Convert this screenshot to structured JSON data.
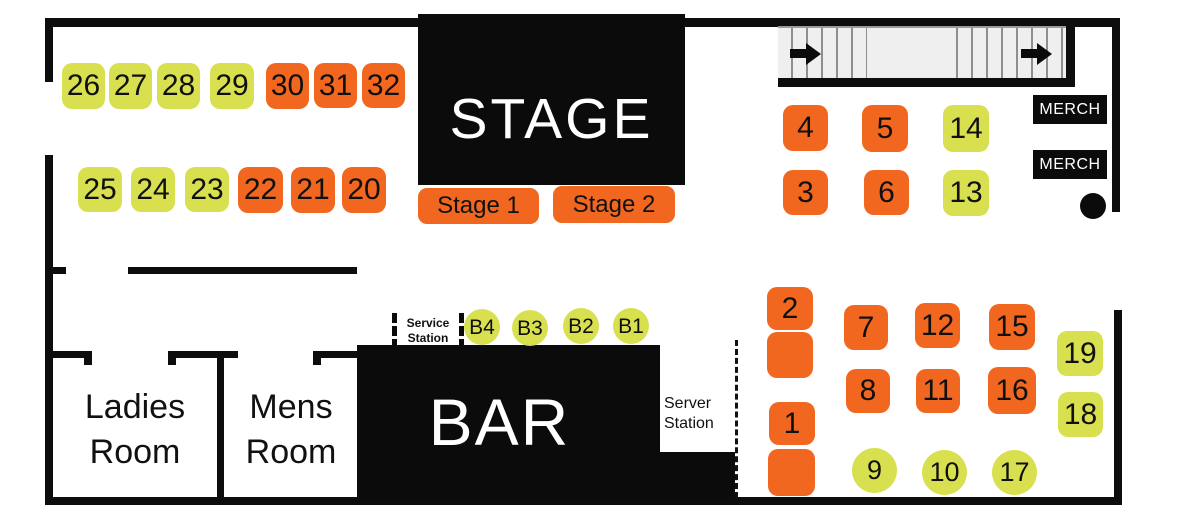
{
  "title": "Venue floor plan seating map",
  "colors": {
    "orange": "#f2671f",
    "yellow": "#d9e04f",
    "wall": "#0d0d0d"
  },
  "stage": {
    "title": "STAGE",
    "stage1_label": "Stage 1",
    "stage2_label": "Stage 2"
  },
  "bar": {
    "title": "BAR"
  },
  "merch": {
    "top_label": "MERCH",
    "bottom_label": "MERCH"
  },
  "restrooms": {
    "ladies": {
      "line1": "Ladies",
      "line2": "Room"
    },
    "mens": {
      "line1": "Mens",
      "line2": "Room"
    }
  },
  "stations": {
    "service": {
      "line1": "Service",
      "line2": "Station"
    },
    "server": {
      "line1": "Server",
      "line2": "Station"
    }
  },
  "tables": [
    {
      "id": "26",
      "label": "26",
      "color": "yellow",
      "shape": "square",
      "x": 62,
      "y": 63,
      "w": 43,
      "h": 46
    },
    {
      "id": "27",
      "label": "27",
      "color": "yellow",
      "shape": "square",
      "x": 109,
      "y": 63,
      "w": 43,
      "h": 46
    },
    {
      "id": "28",
      "label": "28",
      "color": "yellow",
      "shape": "square",
      "x": 157,
      "y": 63,
      "w": 43,
      "h": 46
    },
    {
      "id": "29",
      "label": "29",
      "color": "yellow",
      "shape": "square",
      "x": 210,
      "y": 63,
      "w": 44,
      "h": 46
    },
    {
      "id": "30",
      "label": "30",
      "color": "orange",
      "shape": "square",
      "x": 266,
      "y": 63,
      "w": 43,
      "h": 46
    },
    {
      "id": "31",
      "label": "31",
      "color": "orange",
      "shape": "square",
      "x": 314,
      "y": 63,
      "w": 43,
      "h": 45
    },
    {
      "id": "32",
      "label": "32",
      "color": "orange",
      "shape": "square",
      "x": 362,
      "y": 63,
      "w": 43,
      "h": 45
    },
    {
      "id": "25",
      "label": "25",
      "color": "yellow",
      "shape": "square",
      "x": 78,
      "y": 167,
      "w": 44,
      "h": 45
    },
    {
      "id": "24",
      "label": "24",
      "color": "yellow",
      "shape": "square",
      "x": 131,
      "y": 167,
      "w": 44,
      "h": 45
    },
    {
      "id": "23",
      "label": "23",
      "color": "yellow",
      "shape": "square",
      "x": 185,
      "y": 167,
      "w": 44,
      "h": 45
    },
    {
      "id": "22",
      "label": "22",
      "color": "orange",
      "shape": "square",
      "x": 238,
      "y": 167,
      "w": 45,
      "h": 46
    },
    {
      "id": "21",
      "label": "21",
      "color": "orange",
      "shape": "square",
      "x": 291,
      "y": 167,
      "w": 44,
      "h": 46
    },
    {
      "id": "20",
      "label": "20",
      "color": "orange",
      "shape": "square",
      "x": 342,
      "y": 167,
      "w": 44,
      "h": 46
    },
    {
      "id": "4",
      "label": "4",
      "color": "orange",
      "shape": "square",
      "x": 783,
      "y": 105,
      "w": 45,
      "h": 46
    },
    {
      "id": "5",
      "label": "5",
      "color": "orange",
      "shape": "square",
      "x": 862,
      "y": 105,
      "w": 46,
      "h": 47
    },
    {
      "id": "14",
      "label": "14",
      "color": "yellow",
      "shape": "square",
      "x": 943,
      "y": 105,
      "w": 46,
      "h": 47
    },
    {
      "id": "3",
      "label": "3",
      "color": "orange",
      "shape": "square",
      "x": 783,
      "y": 170,
      "w": 45,
      "h": 45
    },
    {
      "id": "6",
      "label": "6",
      "color": "orange",
      "shape": "square",
      "x": 864,
      "y": 170,
      "w": 45,
      "h": 45
    },
    {
      "id": "13",
      "label": "13",
      "color": "yellow",
      "shape": "square",
      "x": 943,
      "y": 170,
      "w": 46,
      "h": 46
    },
    {
      "id": "2",
      "label": "2",
      "color": "orange",
      "shape": "square",
      "x": 767,
      "y": 287,
      "w": 46,
      "h": 43
    },
    {
      "id": "2b",
      "label": "",
      "color": "orange",
      "shape": "square",
      "x": 767,
      "y": 332,
      "w": 46,
      "h": 46
    },
    {
      "id": "7",
      "label": "7",
      "color": "orange",
      "shape": "square",
      "x": 844,
      "y": 305,
      "w": 44,
      "h": 45
    },
    {
      "id": "12",
      "label": "12",
      "color": "orange",
      "shape": "square",
      "x": 915,
      "y": 303,
      "w": 45,
      "h": 45
    },
    {
      "id": "15",
      "label": "15",
      "color": "orange",
      "shape": "square",
      "x": 989,
      "y": 304,
      "w": 46,
      "h": 46
    },
    {
      "id": "8",
      "label": "8",
      "color": "orange",
      "shape": "square",
      "x": 846,
      "y": 369,
      "w": 44,
      "h": 44
    },
    {
      "id": "11",
      "label": "11",
      "color": "orange",
      "shape": "square",
      "x": 916,
      "y": 369,
      "w": 44,
      "h": 44
    },
    {
      "id": "16",
      "label": "16",
      "color": "orange",
      "shape": "square",
      "x": 988,
      "y": 367,
      "w": 48,
      "h": 47
    },
    {
      "id": "19",
      "label": "19",
      "color": "yellow",
      "shape": "square",
      "x": 1057,
      "y": 331,
      "w": 46,
      "h": 45
    },
    {
      "id": "18",
      "label": "18",
      "color": "yellow",
      "shape": "square",
      "x": 1058,
      "y": 392,
      "w": 45,
      "h": 45
    },
    {
      "id": "1",
      "label": "1",
      "color": "orange",
      "shape": "square",
      "x": 769,
      "y": 402,
      "w": 46,
      "h": 43
    },
    {
      "id": "1b",
      "label": "",
      "color": "orange",
      "shape": "square",
      "x": 768,
      "y": 449,
      "w": 47,
      "h": 47
    },
    {
      "id": "9",
      "label": "9",
      "color": "yellow",
      "shape": "circle",
      "x": 852,
      "y": 448,
      "w": 45,
      "h": 45
    },
    {
      "id": "10",
      "label": "10",
      "color": "yellow",
      "shape": "circle",
      "x": 922,
      "y": 450,
      "w": 45,
      "h": 45
    },
    {
      "id": "17",
      "label": "17",
      "color": "yellow",
      "shape": "circle",
      "x": 992,
      "y": 450,
      "w": 45,
      "h": 45
    },
    {
      "id": "B4",
      "label": "B4",
      "color": "yellow",
      "shape": "circle",
      "x": 464,
      "y": 309,
      "w": 36,
      "h": 36
    },
    {
      "id": "B3",
      "label": "B3",
      "color": "yellow",
      "shape": "circle",
      "x": 512,
      "y": 310,
      "w": 36,
      "h": 36
    },
    {
      "id": "B2",
      "label": "B2",
      "color": "yellow",
      "shape": "circle",
      "x": 563,
      "y": 308,
      "w": 36,
      "h": 36
    },
    {
      "id": "B1",
      "label": "B1",
      "color": "yellow",
      "shape": "circle",
      "x": 613,
      "y": 308,
      "w": 36,
      "h": 36
    }
  ]
}
